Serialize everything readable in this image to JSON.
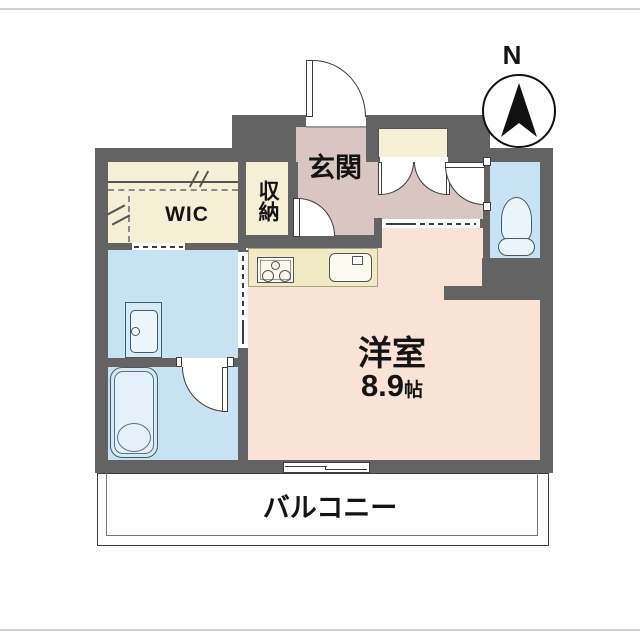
{
  "floorplan": {
    "compass": {
      "label": "N"
    },
    "rooms": {
      "entrance": {
        "label": "玄関"
      },
      "storage": {
        "label": "収納"
      },
      "wic": {
        "label": "WIC"
      },
      "main_room": {
        "label": "洋室",
        "size_value": "8.9",
        "size_unit": "帖"
      },
      "balcony": {
        "label": "バルコニー"
      }
    },
    "fixtures": [
      "stove-icon",
      "kitchen-sink-icon",
      "vanity-sink-icon",
      "bathtub-icon",
      "toilet-icon"
    ],
    "colors": {
      "wall": "#636363",
      "main_room": "#f9e3d7",
      "entrance_hall": "#d9c6c2",
      "closet_cream": "#f5efd6",
      "water_area_blue": "#c6e2f3",
      "kitchen_counter": "#f0ebc4",
      "balcony": "#ffffff",
      "outline": "#3d3d3d"
    }
  }
}
